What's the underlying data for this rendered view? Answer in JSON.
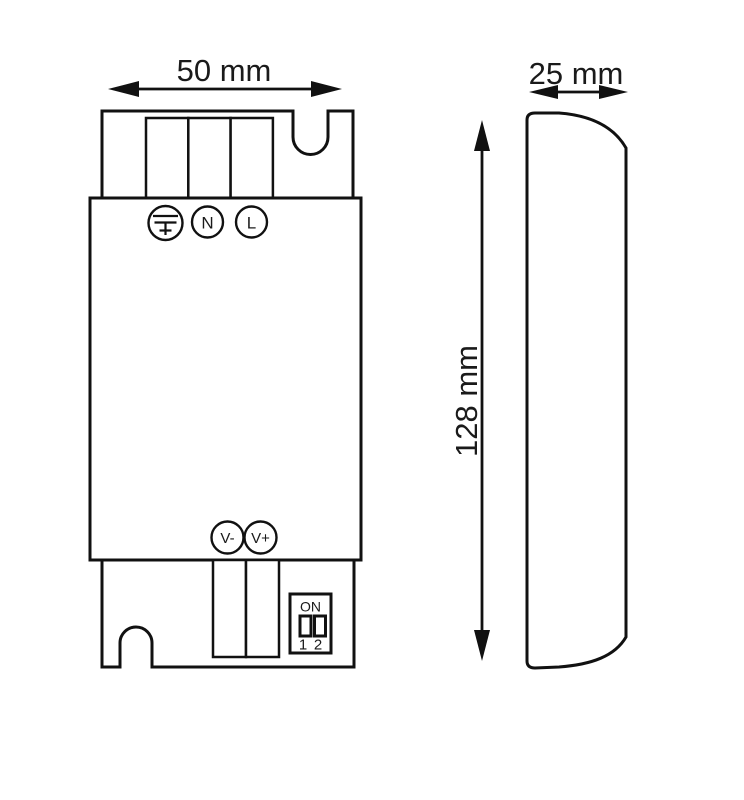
{
  "drawing": {
    "description": "Dimension drawing of LED driver / power supply, front and side views",
    "colors": {
      "line": "#111111",
      "background": "#ffffff",
      "text": "#1a1a1a"
    },
    "front_view": {
      "width_dimension": "50 mm",
      "input_terminals": {
        "earth_icon": "protective-earth-symbol",
        "neutral": "N",
        "line": "L"
      },
      "output_terminals": {
        "negative": "V-",
        "positive": "V+"
      },
      "dip_switch": {
        "label": "ON",
        "positions": [
          "1",
          "2"
        ]
      }
    },
    "side_view": {
      "depth_dimension": "25 mm",
      "height_dimension": "128 mm"
    }
  }
}
